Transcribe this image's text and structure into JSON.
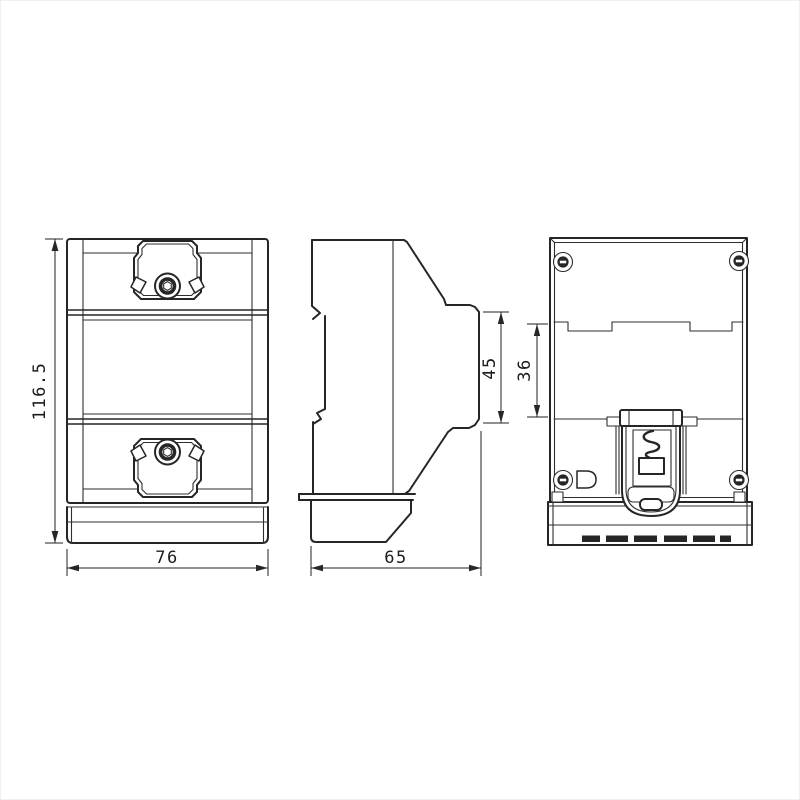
{
  "drawing": {
    "background": "#ffffff",
    "line_color": "#262626",
    "dimensions": {
      "overall_height": "116.5",
      "overall_width": "76",
      "overall_depth": "65",
      "side_step_height": "45",
      "rear_mid_height": "36"
    }
  }
}
